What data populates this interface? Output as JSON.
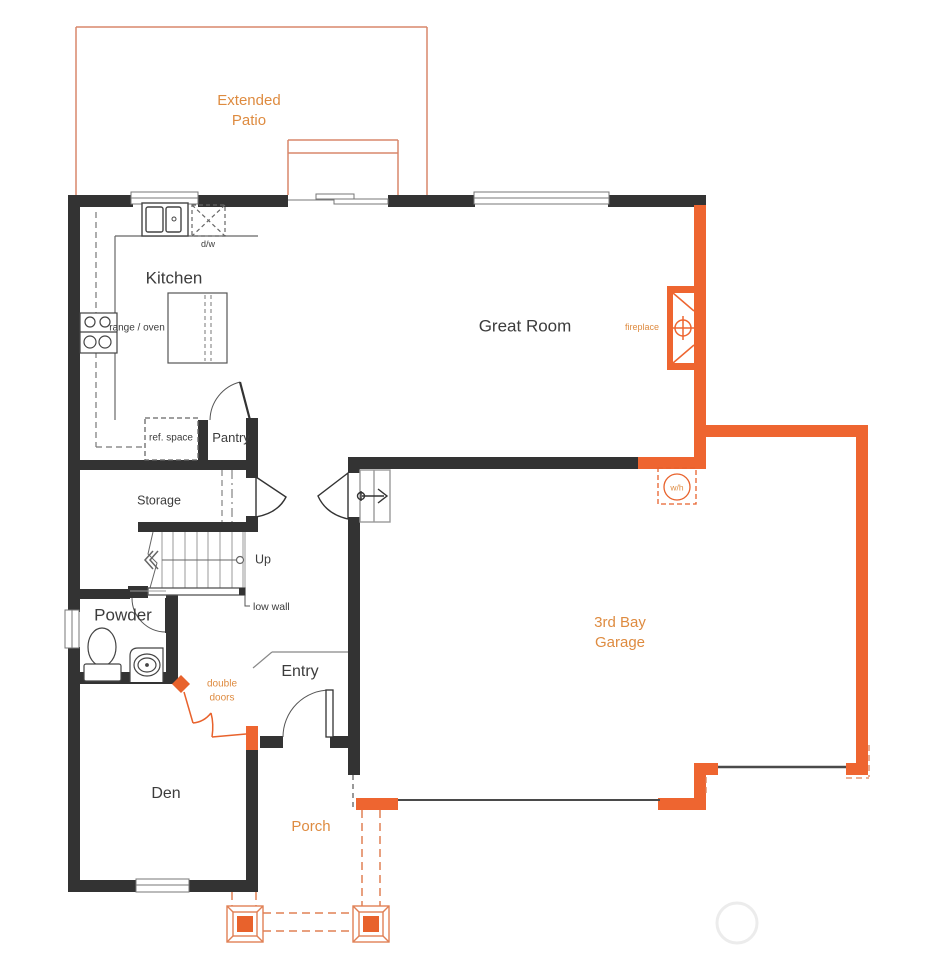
{
  "title": "First Floor Plan",
  "colors": {
    "wall_black": "#333333",
    "wall_orange": "#ee6530",
    "accent_fill": "#e8622c",
    "text_orange": "#de8b40",
    "patio_line": "#d8876b",
    "thin_line": "#888888"
  },
  "rooms": {
    "extended_patio": "Extended Patio",
    "kitchen": "Kitchen",
    "great_room": "Great Room",
    "storage": "Storage",
    "pantry": "Pantry",
    "powder": "Powder",
    "entry": "Entry",
    "den": "Den",
    "porch": "Porch",
    "garage": "3rd Bay Garage"
  },
  "annotations": {
    "dishwasher": "d/w",
    "range_oven": "range / oven",
    "ref_space": "ref. space",
    "stairs_up": "Up",
    "low_wall": "low wall",
    "double_doors": "double doors",
    "fireplace": "fireplace",
    "water_heater": "w/h"
  }
}
